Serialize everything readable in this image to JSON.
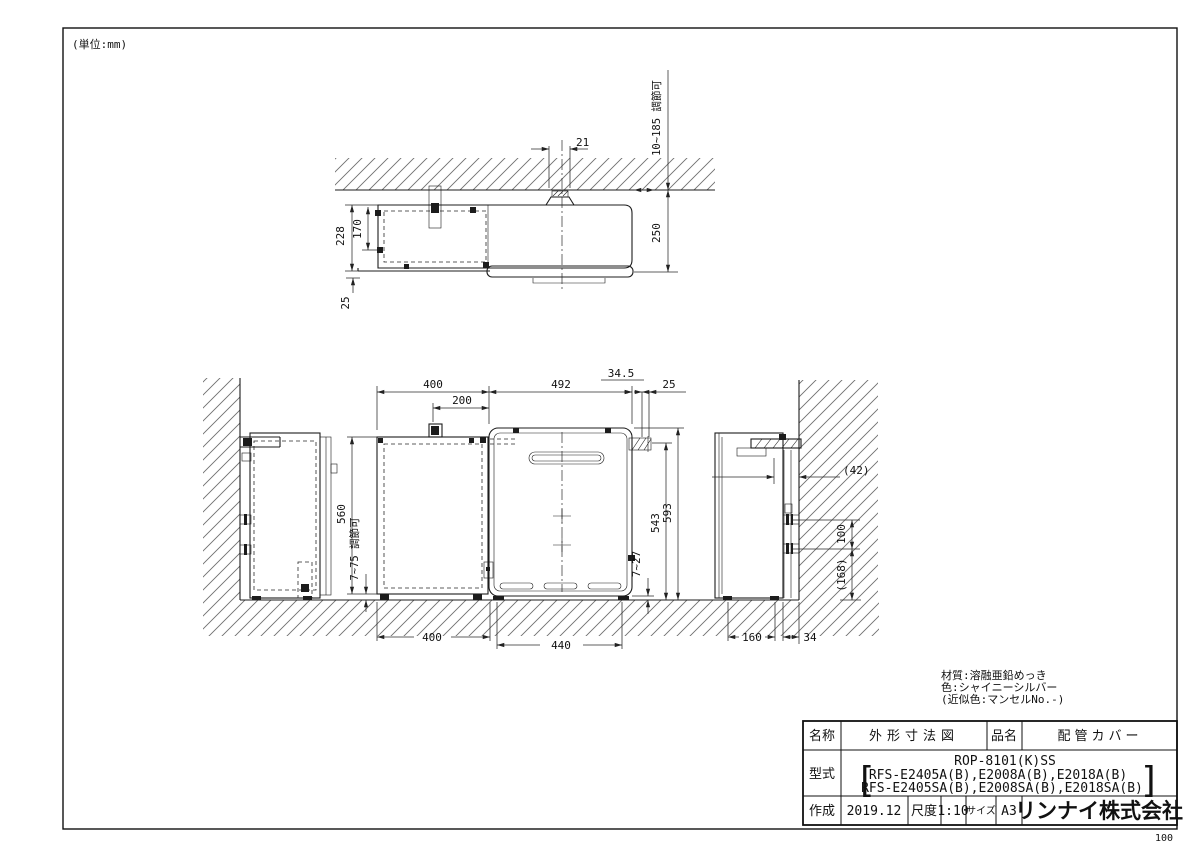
{
  "page": {
    "unit_note": "(単位:mm)",
    "page_number": "100"
  },
  "notes": {
    "material": "材質:溶融亜鉛めっき",
    "color": "色:シャイニーシルバー",
    "approx": "(近似色:マンセルNo.-)"
  },
  "title_block": {
    "name_label": "名称",
    "name_value": "外形寸法図",
    "product_label": "品名",
    "product_value": "配管カバー",
    "model_label": "型式",
    "model_main": "ROP-8101(K)SS",
    "bracket_open": "[",
    "bracket_close": "]",
    "model_line1": "RFS-E2405A(B),E2008A(B),E2018A(B)",
    "model_line2": "RFS-E2405SA(B),E2008SA(B),E2018SA(B)",
    "date_label": "作成",
    "date_value": "2019.12",
    "scale_label": "尺度",
    "scale_value": "1:10",
    "size_label": "サイズ",
    "size_value": "A3",
    "company": "リンナイ株式会社"
  },
  "dims": {
    "top": {
      "bolt": "21",
      "adjust": "10~185 調節可",
      "depth": "250",
      "total": "228",
      "inner": "170",
      "lip": "25"
    },
    "front": {
      "w400": "400",
      "w200": "200",
      "w492": "492",
      "w34_5": "34.5",
      "w25": "25",
      "h560": "560",
      "adjust_left": "7~75 調節可",
      "h543": "543",
      "h593": "593",
      "gap": "7~27",
      "b400": "400",
      "b440": "440"
    },
    "side": {
      "wall": "(42)",
      "pitch": "100",
      "bottom": "(168)",
      "depth": "160",
      "gap": "34"
    }
  }
}
